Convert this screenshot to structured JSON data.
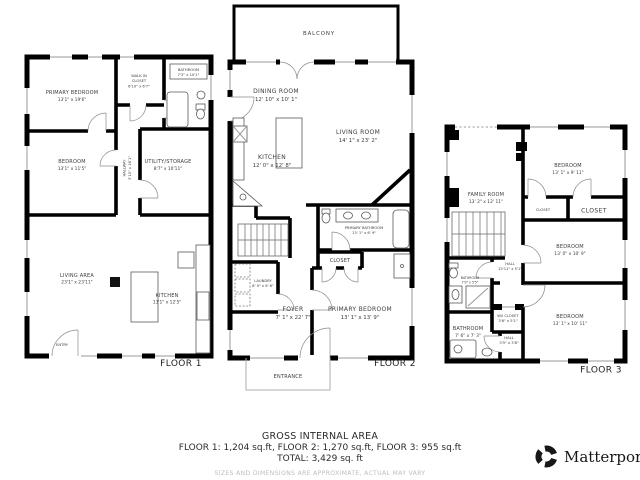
{
  "floors": {
    "floor1": {
      "label": "FLOOR 1",
      "rooms": {
        "primary_bedroom": {
          "name": "PRIMARY BEDROOM",
          "dims": "13'1\" x 19'6\""
        },
        "walk_in_closet": {
          "line1": "WALK IN",
          "line2": "CLOSET",
          "dims": "6'10\" x 6'7\""
        },
        "bathroom": {
          "name": "BATHROOM",
          "dims": "7'3\" x 10'1\""
        },
        "bedroom": {
          "name": "BEDROOM",
          "dims": "13'1\" x 11'5\""
        },
        "hallway": {
          "name": "HALLWAY",
          "dims": "3'10\" x 16'1\""
        },
        "utility_storage": {
          "name": "UTILITY/STORAGE",
          "dims": "8'7\" x 10'11\""
        },
        "living_area": {
          "name": "LIVING AREA",
          "dims": "23'1\" x 23'11\""
        },
        "kitchen": {
          "name": "KITCHEN",
          "dims": "13'1\" x 12'5\""
        },
        "entry": {
          "name": "ENTRY"
        }
      }
    },
    "floor2": {
      "label": "FLOOR 2",
      "rooms": {
        "balcony": {
          "name": "BALCONY"
        },
        "dining_room": {
          "name": "DINING ROOM",
          "dims": "12' 10\" x 10' 1\""
        },
        "living_room": {
          "name": "LIVING ROOM",
          "dims": "14' 1\" x 23' 2\""
        },
        "kitchen": {
          "name": "KITCHEN",
          "dims": "12' 0\" x 12' 8\""
        },
        "primary_bathroom": {
          "name": "PRIMARY BATHROOM",
          "dims": "13' 1\" x 6' 9\""
        },
        "closet": {
          "name": "CLOSET"
        },
        "laundry": {
          "name": "LAUNDRY",
          "dims": "6' 0\" x 6' 6\""
        },
        "foyer": {
          "name": "FOYER",
          "dims": "7' 1\" x 22' 7\""
        },
        "primary_bedroom": {
          "name": "PRIMARY BEDROOM",
          "dims": "13' 1\" x 13' 9\""
        },
        "entrance": {
          "name": "ENTRANCE"
        }
      }
    },
    "floor3": {
      "label": "FLOOR 3",
      "rooms": {
        "family_room": {
          "name": "FAMILY ROOM",
          "dims": "13' 2\" x 12' 11\""
        },
        "bedroom_top": {
          "name": "BEDROOM",
          "dims": "13' 1\" x 9' 11\""
        },
        "closet_small": {
          "name": "CLOSET"
        },
        "closet_large": {
          "name": "CLOSET"
        },
        "bedroom_mid": {
          "name": "BEDROOM",
          "dims": "13' 0\" x 10' 9\""
        },
        "hall_upper": {
          "name": "HALL",
          "dims": "15'11\" x 5'1\""
        },
        "bathroom_upper": {
          "name": "BATHROOM",
          "dims": "7'9\" x 5'5\""
        },
        "wi_closet": {
          "name": "W/I CLOSET",
          "dims": "3'6\" x 5'1\""
        },
        "bathroom_lower": {
          "name": "BATHROOM",
          "dims": "7' 6\" x 7' 3\""
        },
        "hall_lower": {
          "name": "HALL",
          "dims": "3'5\" x 3'8\""
        },
        "bedroom_bottom": {
          "name": "BEDROOM",
          "dims": "13' 1\" x 10' 11\""
        }
      }
    }
  },
  "footer": {
    "title": "GROSS INTERNAL AREA",
    "line1": "FLOOR 1: 1,204 sq.ft, FLOOR 2: 1,270 sq.ft, FLOOR 3: 955 sq.ft",
    "line2": "TOTAL: 3,429 sq. ft",
    "disclaimer": "SIZES AND DIMENSIONS ARE APPROXIMATE, ACTUAL MAY VARY",
    "brand": "Matterport"
  }
}
